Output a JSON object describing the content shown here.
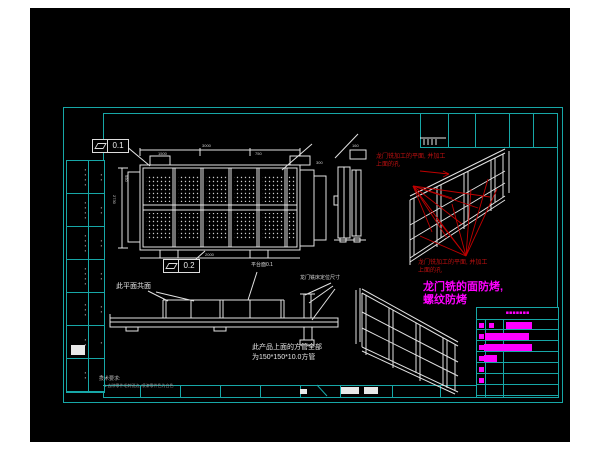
{
  "colors": {
    "canvas_bg": "#000000",
    "frame": "#17a7a7",
    "line": "#e8e8e8",
    "red_annotation": "#c01010",
    "magenta_annotation": "#ff00ff"
  },
  "feature_controls": {
    "top": {
      "symbol": "flatness",
      "value": "0.1"
    },
    "bottom": {
      "symbol": "flatness",
      "value": "0.2"
    }
  },
  "annotations": {
    "coplanar": "此平面共面",
    "platform": "平台面0.1",
    "gantry_locating": "龙门铣床定位尺寸",
    "square_tube_line1": "此产品上面的方管全部",
    "square_tube_line2": "为150*150*10.0方管",
    "red_top_line1": "龙门铣加工的平面, 并加工",
    "red_top_line2": "上面的孔",
    "red_bottom_line1": "龙门铣加工的平面, 并加工",
    "red_bottom_line2": "上面的孔",
    "magenta_line1": "龙门铣的面防烤,",
    "magenta_line2": "螺纹防烤"
  },
  "tech_notes": {
    "title": "技术要求:",
    "line1": "1.去除零件毛刺锐边, 喷漆零件色为白色"
  },
  "dims": {
    "d0": "3000",
    "d1": "1500",
    "d2": "750",
    "d3": "2730",
    "d4": "950",
    "d5": "2000",
    "d6": "300",
    "d7": "160"
  },
  "bom": {
    "rows": [
      {
        "name": "▪▪▪▪",
        "qty": "▪▪"
      },
      {
        "name": "▪▪▪▪",
        "qty": "▪▪"
      },
      {
        "name": "▪▪▪▪",
        "qty": "▪▪"
      },
      {
        "name": "▪▪▪▪",
        "qty": "▪▪"
      },
      {
        "name": "▪▪▪",
        "qty": "▪▪"
      },
      {
        "name": "▪▪",
        "qty": "▪"
      },
      {
        "name": "▪▪",
        "qty": "▪"
      }
    ]
  },
  "param_table": {
    "header": "▪▪▪▪▪▪▪"
  }
}
